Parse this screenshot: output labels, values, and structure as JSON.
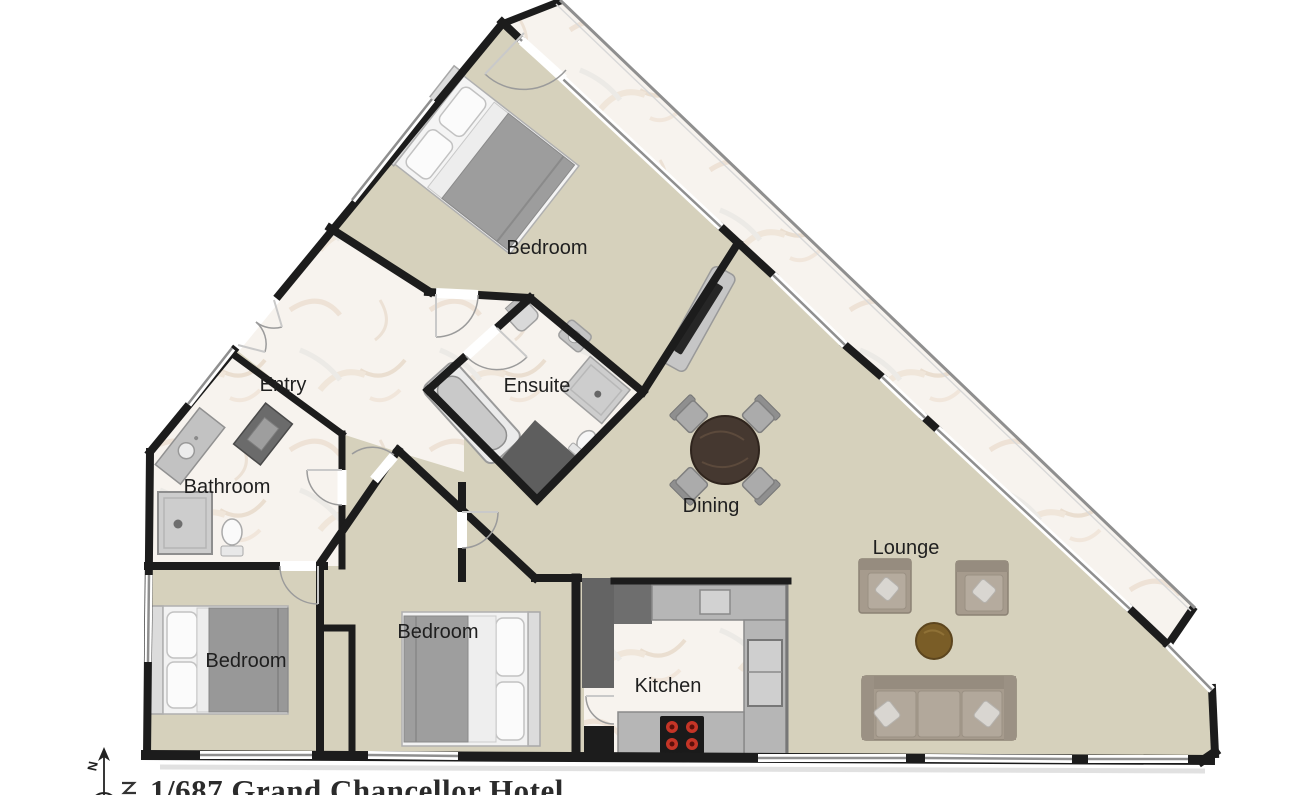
{
  "title": "1/687 Grand Chancellor Hotel",
  "compass": {
    "north_label": "N"
  },
  "rooms": {
    "bedroom_top": {
      "label": "Bedroom"
    },
    "ensuite": {
      "label": "Ensuite"
    },
    "entry": {
      "label": "Entry"
    },
    "bathroom": {
      "label": "Bathroom"
    },
    "bedroom_left": {
      "label": "Bedroom"
    },
    "bedroom_middle": {
      "label": "Bedroom"
    },
    "kitchen": {
      "label": "Kitchen"
    },
    "dining": {
      "label": "Dining"
    },
    "lounge": {
      "label": "Lounge"
    }
  },
  "legend_colors": {
    "floor_main": "#d6d1bc",
    "floor_marble": "#f7f3ee",
    "wall": "#1c1c1c",
    "window_glass": "#8f8f8f",
    "counter": "#b6b6b6",
    "service_dark": "#646464",
    "sofa": "#a69b8d",
    "coffee_table": "#7a5d27",
    "dining_table": "#453830",
    "stove": "#1a1a1a",
    "burner_red": "#c53527"
  },
  "furniture_icons": [
    "double-bed",
    "double-bed",
    "double-bed",
    "bathtub",
    "shower",
    "toilet",
    "vanity",
    "washer",
    "dining-table",
    "dining-chair",
    "armchair",
    "sofa",
    "coffee-table",
    "tv-console",
    "kitchen-counter",
    "stove",
    "fridge",
    "sink"
  ]
}
